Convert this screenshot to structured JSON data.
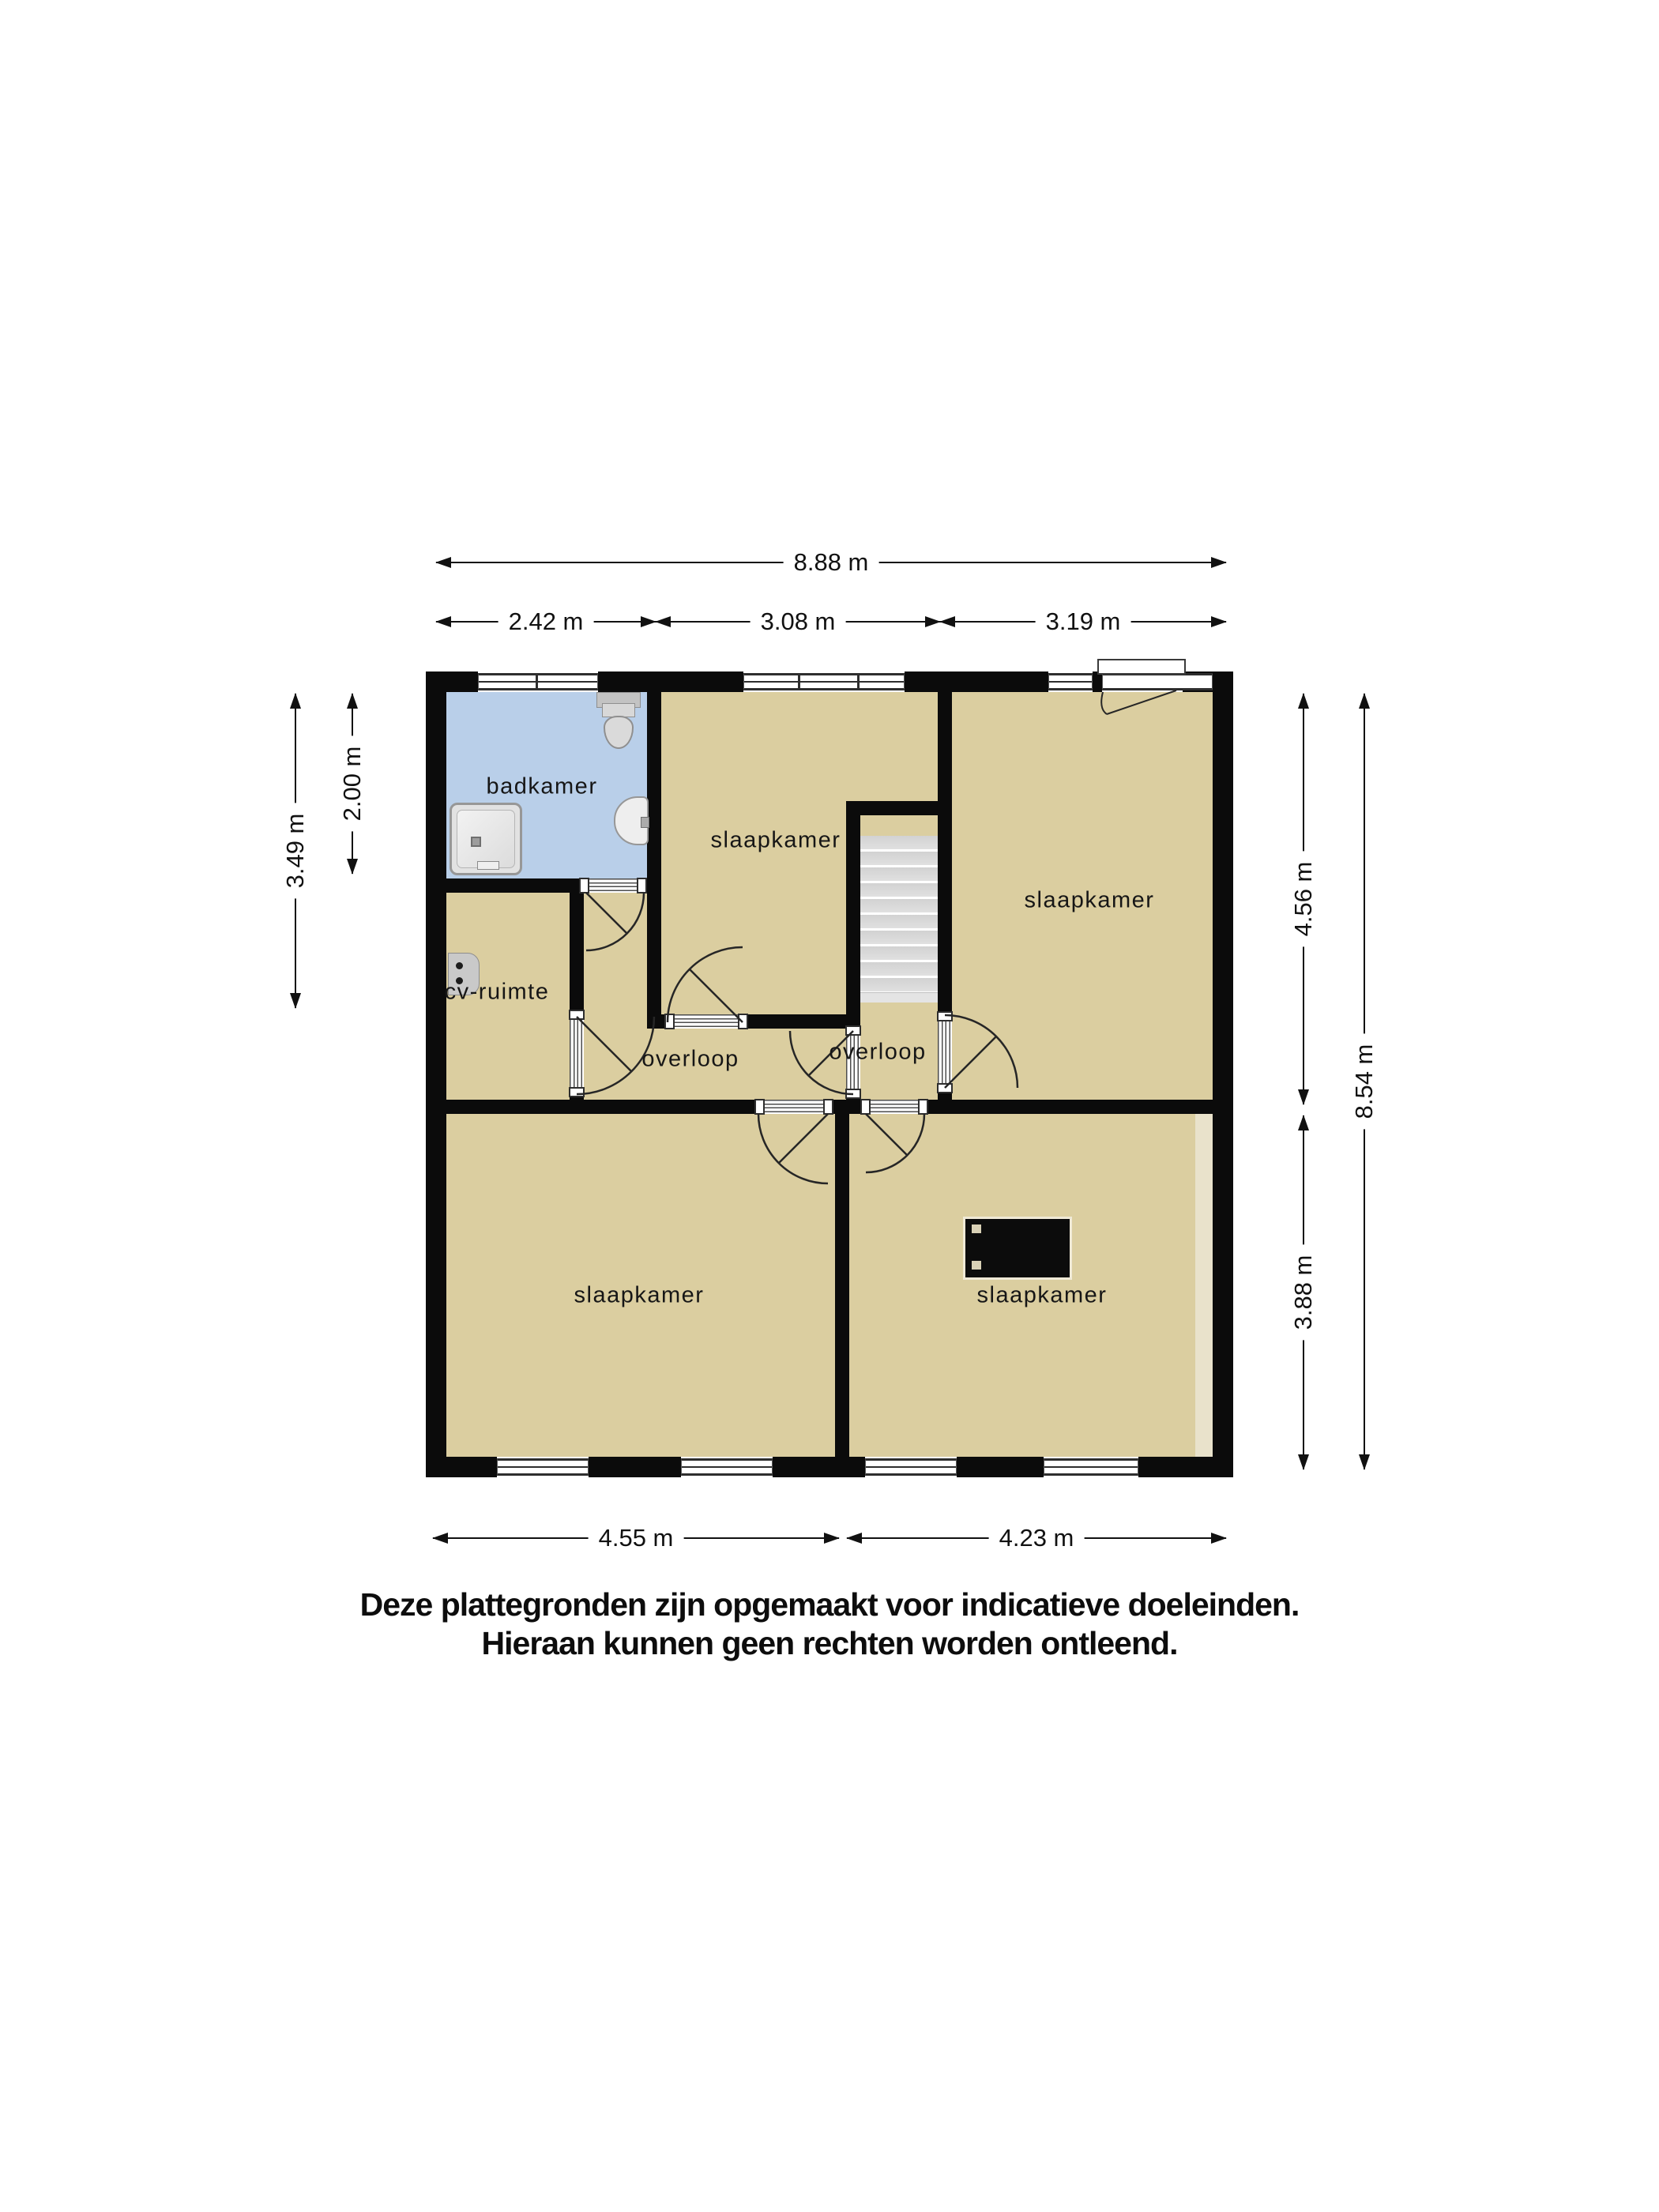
{
  "floorplan": {
    "rooms": {
      "badkamer": "badkamer",
      "slaapkamer_top_middle": "slaapkamer",
      "slaapkamer_top_right": "slaapkamer",
      "cv_ruimte": "cv-ruimte",
      "overloop_west": "overloop",
      "overloop_east": "overloop",
      "slaapkamer_bottom_left": "slaapkamer",
      "slaapkamer_bottom_right": "slaapkamer"
    },
    "dimensions": {
      "top_total": "8.88 m",
      "top_left": "2.42 m",
      "top_middle": "3.08 m",
      "top_right": "3.19 m",
      "left_total": "3.49 m",
      "left_bathroom": "2.00 m",
      "right_upper": "4.56 m",
      "right_lower": "3.88 m",
      "right_total": "8.54 m",
      "bottom_left": "4.55 m",
      "bottom_right": "4.23 m"
    },
    "fixtures": {
      "shower": "shower-tray",
      "toilet": "toilet",
      "sink": "washbasin",
      "boiler": "cv-boiler",
      "stairs": "staircase",
      "chimney": "chimney"
    },
    "colors": {
      "wall": "#0b0b0b",
      "room_fill": "#dbcea0",
      "bathroom_fill": "#b9cfe9",
      "stairs_fill": "#d6d6d6",
      "accent_strip": "#e9e2cb",
      "dimension_text": "#111111"
    }
  },
  "disclaimer": {
    "line1": "Deze plattegronden zijn opgemaakt voor indicatieve doeleinden.",
    "line2": "Hieraan kunnen geen rechten worden ontleend."
  }
}
